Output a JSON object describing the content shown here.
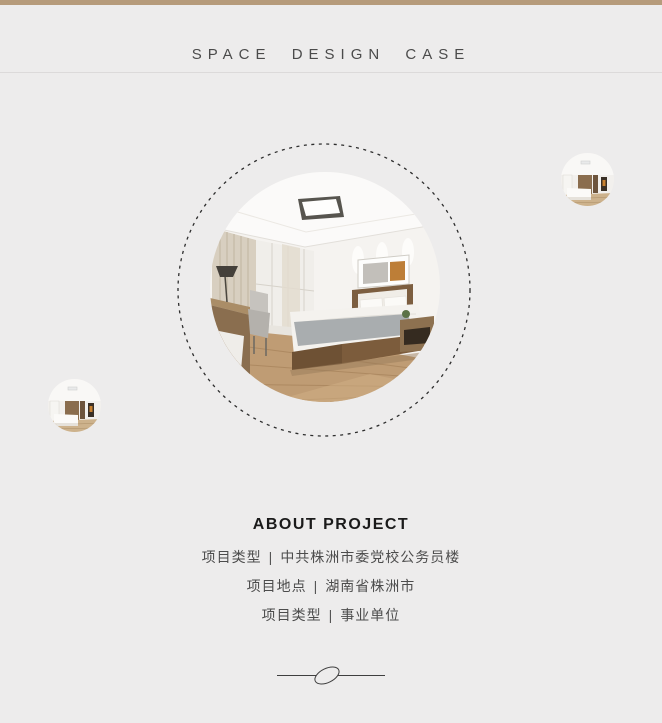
{
  "page": {
    "background": "#edecec",
    "accent_bar_color": "#b69b7b"
  },
  "header": {
    "title": "SPACE DESIGN CASE"
  },
  "gallery": {
    "main_photo": "bedroom-interior-photo",
    "thumbnail_top_right": "bedroom-interior-thumbnail",
    "thumbnail_left": "bedroom-interior-thumbnail"
  },
  "about": {
    "title": "ABOUT PROJECT",
    "separator": "|",
    "rows": [
      {
        "label": "项目类型",
        "value": "中共株洲市委党校公务员楼"
      },
      {
        "label": "项目地点",
        "value": "湖南省株洲市"
      },
      {
        "label": "项目类型",
        "value": "事业单位"
      }
    ]
  }
}
